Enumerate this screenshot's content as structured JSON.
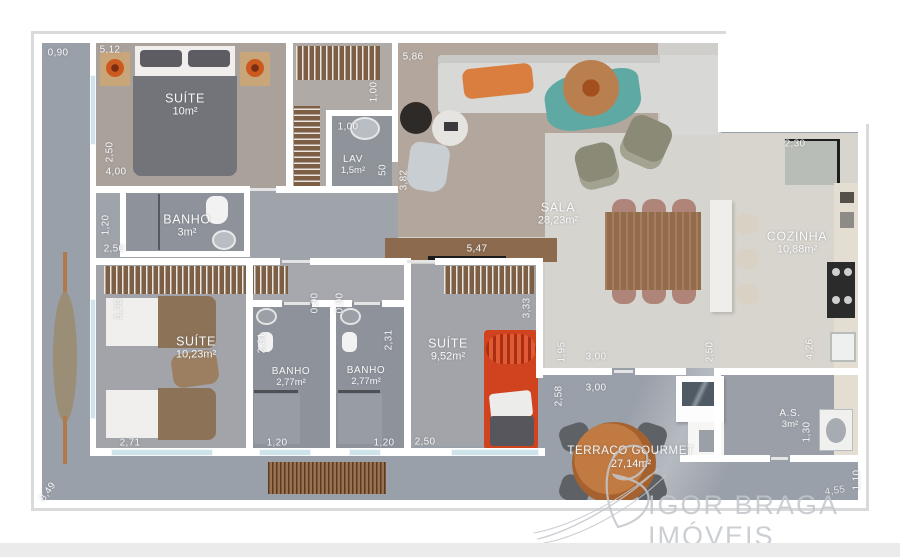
{
  "plan_title": "Apartment floor plan",
  "watermark": {
    "text": "IGOR BRAGA IMÓVEIS",
    "logo": "script-B-flourish"
  },
  "rooms": {
    "suite1": {
      "name": "SUÍTE",
      "area": "10m²"
    },
    "lav": {
      "name": "LAV",
      "area": "1,5m²"
    },
    "sala": {
      "name": "SALA",
      "area": "28,23m²"
    },
    "cozinha": {
      "name": "COZINHA",
      "area": "10,88m²"
    },
    "banho_suite1": {
      "name": "BANHO",
      "area": "3m²"
    },
    "suite2": {
      "name": "SUÍTE",
      "area": "10,23m²"
    },
    "banho_suite2": {
      "name": "BANHO",
      "area": "2,77m²"
    },
    "banho_suite3": {
      "name": "BANHO",
      "area": "2,77m²"
    },
    "suite3": {
      "name": "SUÍTE",
      "area": "9,52m²"
    },
    "area_servico": {
      "name": "A.S.",
      "area": "3m²"
    },
    "terraco": {
      "name": "TERRAÇO GOURMET",
      "area": "27,14m²"
    }
  },
  "dims": [
    {
      "t": "0,90"
    },
    {
      "t": "5,12"
    },
    {
      "t": "5,86"
    },
    {
      "t": "1,00"
    },
    {
      "t": "1,00"
    },
    {
      "t": "50"
    },
    {
      "t": "3,82"
    },
    {
      "t": "2,30"
    },
    {
      "t": "2,50"
    },
    {
      "t": "4,00"
    },
    {
      "t": "1,20"
    },
    {
      "t": "2,50"
    },
    {
      "t": "5,47"
    },
    {
      "t": "3,33"
    },
    {
      "t": "2,71"
    },
    {
      "t": "0,90"
    },
    {
      "t": "0,90"
    },
    {
      "t": "2,31"
    },
    {
      "t": "2,31"
    },
    {
      "t": "1,20"
    },
    {
      "t": "1,20"
    },
    {
      "t": "2,50"
    },
    {
      "t": "3,33"
    },
    {
      "t": "1,95"
    },
    {
      "t": "3,00"
    },
    {
      "t": "2,58"
    },
    {
      "t": "3,00"
    },
    {
      "t": "2,50"
    },
    {
      "t": "4,26"
    },
    {
      "t": "1,30"
    },
    {
      "t": "1,10"
    },
    {
      "t": "8,49"
    },
    {
      "t": "4,55"
    }
  ],
  "colors": {
    "terrace_floor": "#9aa0a9",
    "room_floor_warm": "#aaa19b",
    "bath_floor": "#8e939b",
    "tile_floor": "#d6d4cf",
    "wall": "#ffffff",
    "bed_red": "#d1431f",
    "lamp_orange": "#cc5a1f",
    "throw_teal": "#5fa9a4",
    "wood": "#9c7350",
    "watermark_gray": "#c3c7cc"
  }
}
